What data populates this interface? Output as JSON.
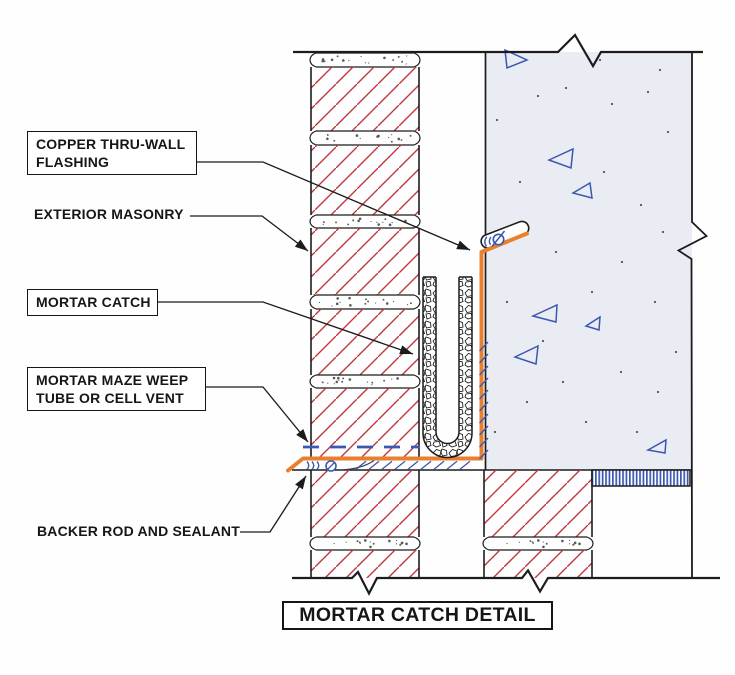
{
  "title": {
    "text": "MORTAR CATCH DETAIL"
  },
  "callouts": [
    {
      "id": "copper_flashing",
      "label": "COPPER THRU-WALL FLASHING",
      "boxed": true
    },
    {
      "id": "exterior_masonry",
      "label": "EXTERIOR MASONRY",
      "boxed": false
    },
    {
      "id": "mortar_catch",
      "label": "MORTAR CATCH",
      "boxed": true
    },
    {
      "id": "weep_tube",
      "label": "MORTAR MAZE WEEP TUBE OR CELL VENT",
      "boxed": true
    },
    {
      "id": "backer_rod",
      "label": "BACKER ROD AND SEALANT",
      "boxed": false
    }
  ],
  "components": [
    {
      "name": "exterior-masonry-wythe",
      "texture": "red-diagonal-hatch-with-tooled-mortar-joints"
    },
    {
      "name": "concrete-backup-wall",
      "texture": "aggregate-triangles-and-specks"
    },
    {
      "name": "copper-thru-wall-flashing",
      "shape": "vertical-leg-with-horizontal-leg-and-drip-edge"
    },
    {
      "name": "flashing-termination-reglet",
      "shape": "rounded-pill-with-fastener"
    },
    {
      "name": "mortar-catch-channel",
      "fill": "gravel-rubble-u-shape"
    },
    {
      "name": "weep-tube-line",
      "style": "blue-dashed"
    },
    {
      "name": "backer-rod-and-sealant-symbol",
      "style": "blue-arcs-and-circle"
    },
    {
      "name": "mortar-bed-hatch",
      "style": "blue-diagonal-strokes"
    },
    {
      "name": "striped-filler-band",
      "style": "vertical-blue-stripes"
    },
    {
      "name": "break-marks",
      "style": "zigzag-cut-symbols"
    }
  ],
  "colors": {
    "line": "#1c1c1c",
    "masonry_hatch": "#c23640",
    "flashing_copper": "#e8802e",
    "detail_blue": "#3a58b0",
    "concrete_fill": "#eaecf4",
    "stipple": "#5a5a5a",
    "paper": "#fefefe"
  }
}
